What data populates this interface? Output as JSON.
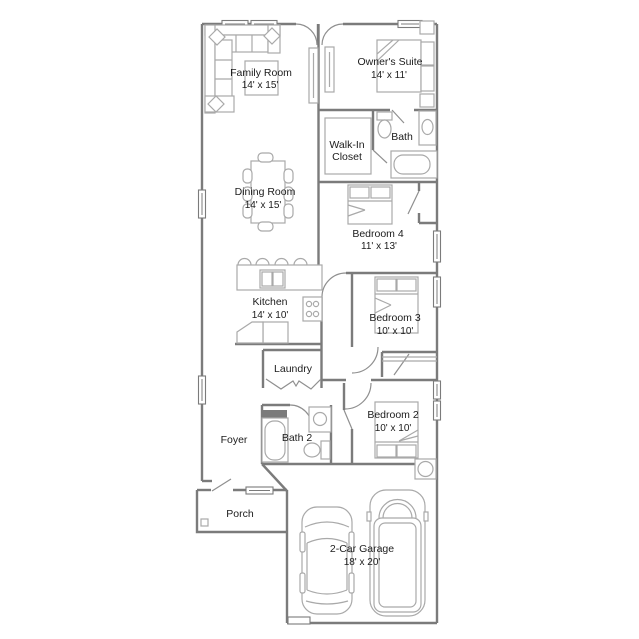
{
  "rooms": {
    "family_room": {
      "name": "Family Room",
      "dims": "14' x 15'"
    },
    "owners_suite": {
      "name": "Owner's Suite",
      "dims": "14' x 11'"
    },
    "walk_in_closet": {
      "name_line1": "Walk-In",
      "name_line2": "Closet"
    },
    "bath": {
      "name": "Bath"
    },
    "dining_room": {
      "name": "Dining Room",
      "dims": "14' x 15'"
    },
    "bedroom4": {
      "name": "Bedroom 4",
      "dims": "11' x 13'"
    },
    "kitchen": {
      "name": "Kitchen",
      "dims": "14' x 10'"
    },
    "bedroom3": {
      "name": "Bedroom 3",
      "dims": "10' x 10'"
    },
    "laundry": {
      "name": "Laundry"
    },
    "bedroom2": {
      "name": "Bedroom 2",
      "dims": "10' x 10'"
    },
    "foyer": {
      "name": "Foyer"
    },
    "bath2": {
      "name": "Bath 2"
    },
    "porch": {
      "name": "Porch"
    },
    "garage": {
      "name": "2-Car Garage",
      "dims": "18' x 20'"
    }
  },
  "colors": {
    "background": "#ffffff",
    "wall": "#7b7b7b",
    "door": "#8f8f8f",
    "furniture": "#a9a9a9",
    "text": "#1c1c1c"
  }
}
